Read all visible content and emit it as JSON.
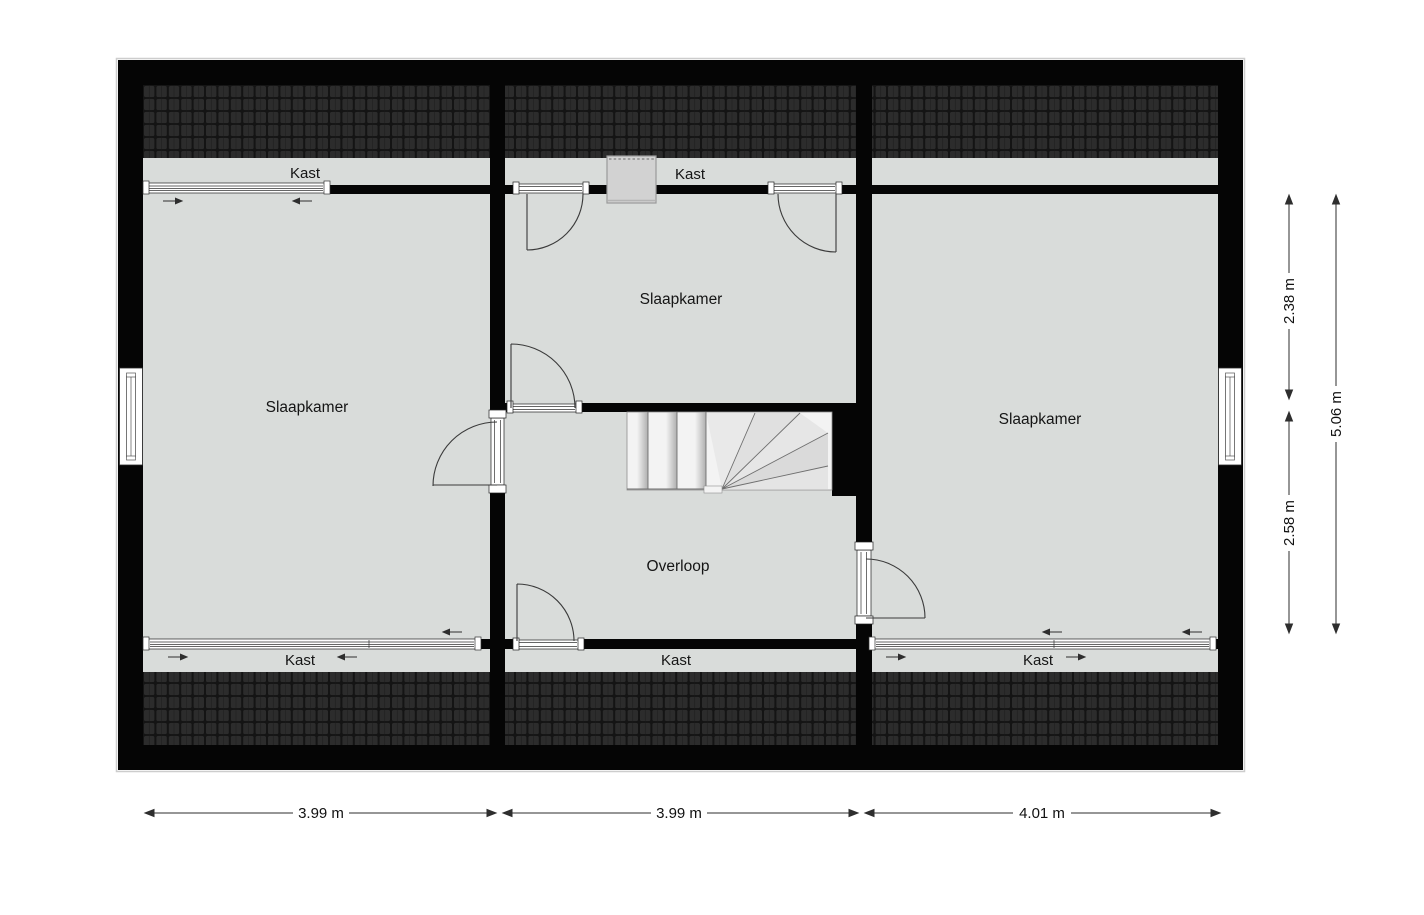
{
  "floorplan": {
    "rooms": [
      {
        "id": "slaapkamer-left",
        "label": "Slaapkamer"
      },
      {
        "id": "slaapkamer-middle",
        "label": "Slaapkamer"
      },
      {
        "id": "slaapkamer-right",
        "label": "Slaapkamer"
      },
      {
        "id": "overloop",
        "label": "Overloop"
      }
    ],
    "closets": [
      {
        "id": "kast-top-left",
        "label": "Kast"
      },
      {
        "id": "kast-top-middle",
        "label": "Kast"
      },
      {
        "id": "kast-bottom-left",
        "label": "Kast"
      },
      {
        "id": "kast-bottom-middle",
        "label": "Kast"
      },
      {
        "id": "kast-bottom-right",
        "label": "Kast"
      }
    ],
    "dimensions": {
      "bottom": [
        "3.99 m",
        "3.99 m",
        "4.01 m"
      ],
      "right_inner": [
        "2.38 m",
        "2.58 m"
      ],
      "right_total": "5.06 m"
    },
    "colors": {
      "wall": "#050505",
      "floor": "#d9dcda",
      "roof_base": "#141414",
      "roof_tile": "#2c2c2c",
      "chimney": "#d2d2d2",
      "stairs": "#f3f3f3",
      "dimension": "#2e2e2e"
    }
  }
}
